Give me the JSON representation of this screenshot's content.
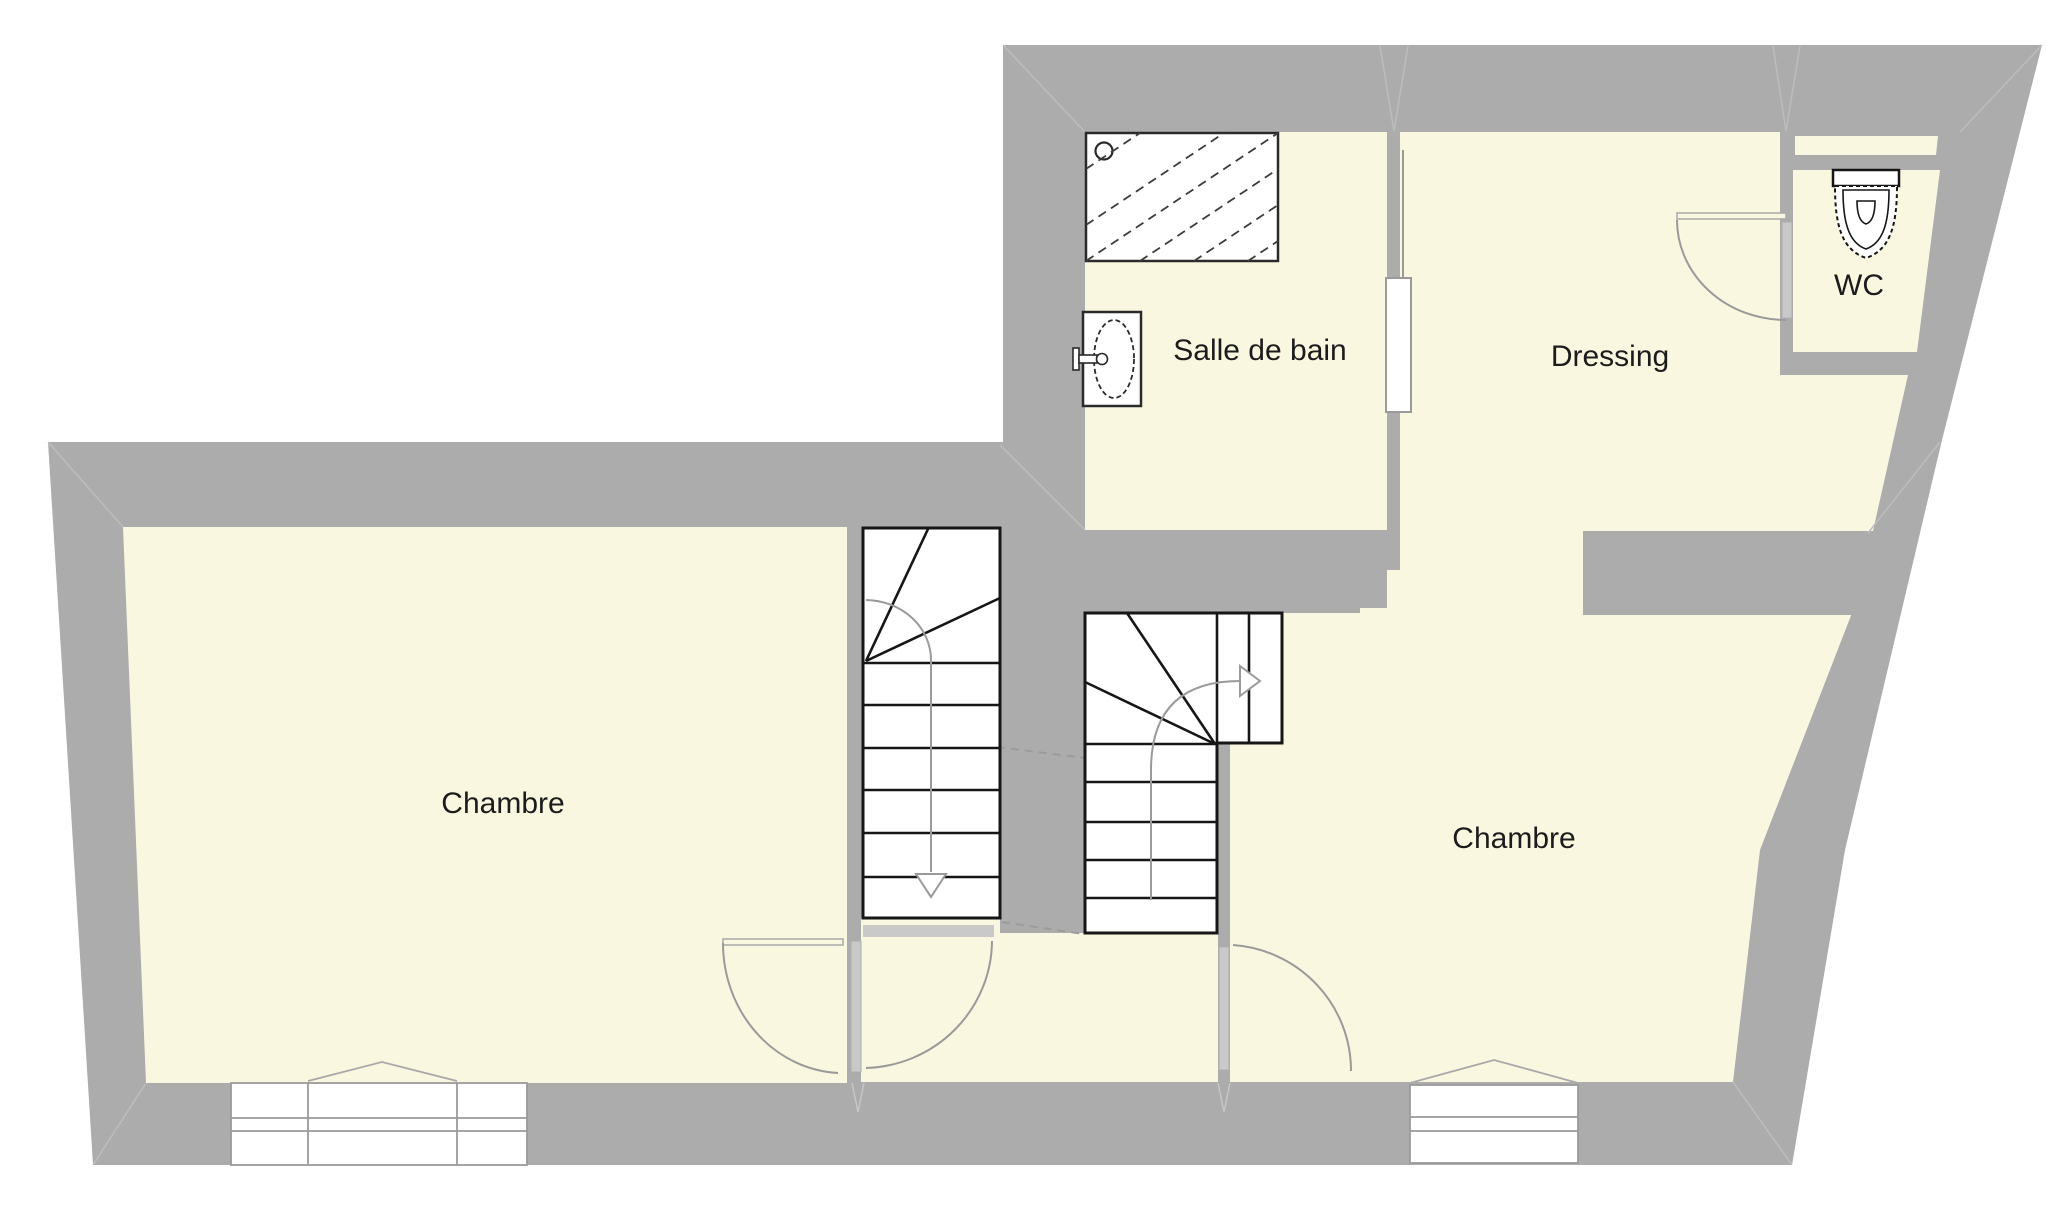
{
  "floor_plan": {
    "type": "architectural-floor-plan",
    "floor_kind": "upper floor (bedrooms level)",
    "rooms": [
      {
        "id": "chambre-left",
        "label": "Chambre"
      },
      {
        "id": "salle-de-bain",
        "label": "Salle de bain"
      },
      {
        "id": "dressing",
        "label": "Dressing"
      },
      {
        "id": "wc",
        "label": "WC"
      },
      {
        "id": "chambre-right",
        "label": "Chambre"
      }
    ],
    "fixtures": [
      {
        "icon": "shower-icon",
        "room": "salle-de-bain"
      },
      {
        "icon": "sink-icon",
        "room": "salle-de-bain"
      },
      {
        "icon": "toilet-icon",
        "room": "wc"
      }
    ],
    "stairs": [
      {
        "id": "staircase-left",
        "arrow": "down"
      },
      {
        "id": "staircase-right",
        "arrow": "right"
      }
    ],
    "doors": [
      {
        "id": "door-chambre-left",
        "type": "swing"
      },
      {
        "id": "door-chambre-right",
        "type": "swing"
      },
      {
        "id": "door-wc",
        "type": "swing"
      },
      {
        "id": "door-salle-de-bain",
        "type": "sliding"
      }
    ],
    "windows": [
      {
        "id": "window-chambre-left"
      },
      {
        "id": "window-chambre-right"
      }
    ],
    "colors": {
      "wall": "#acacac",
      "floor": "#faf7e0",
      "fixture_line": "#1c1c1c",
      "swing_arc": "#9a9a9a",
      "door_leaf": "#c9c9c9",
      "background": "#ffffff"
    }
  }
}
